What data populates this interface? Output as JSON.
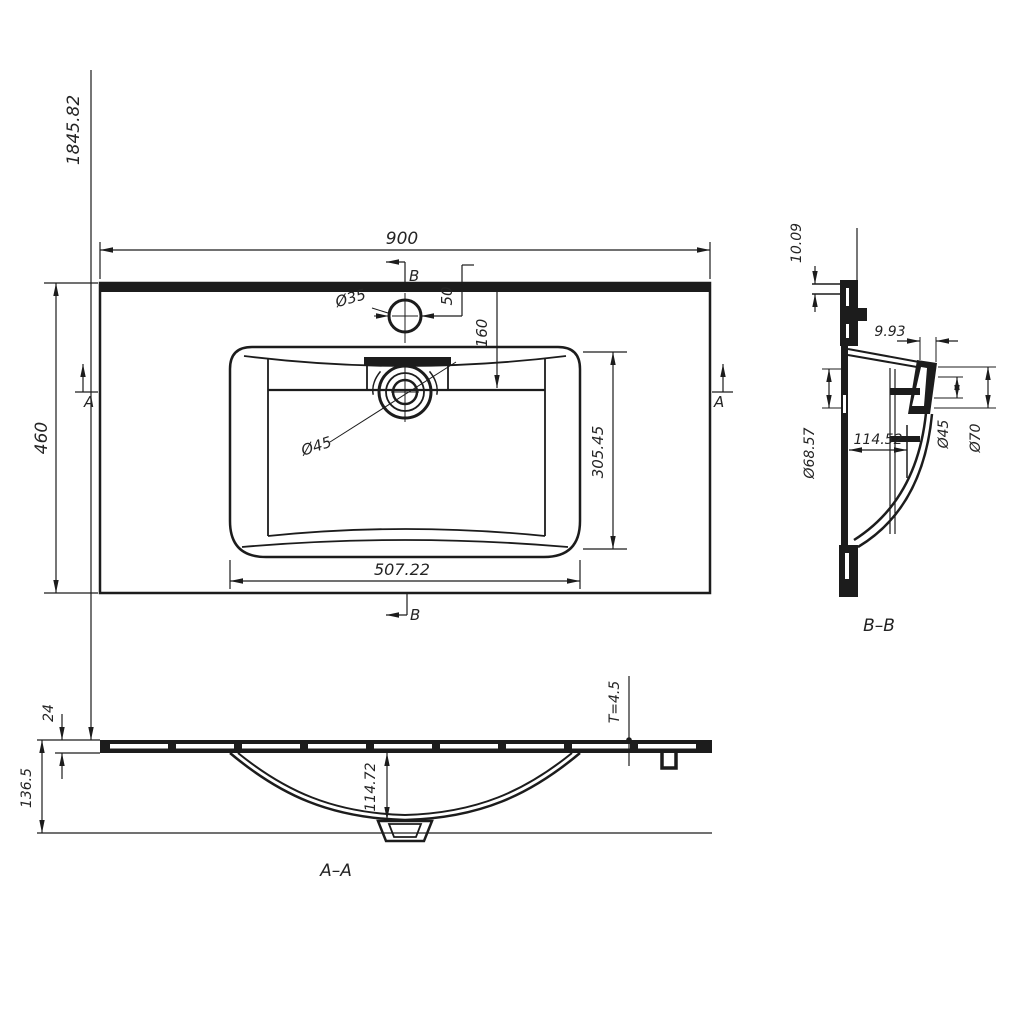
{
  "drawing": {
    "background": "#ffffff",
    "line_color": "#1c1c1c",
    "top_view": {
      "dim_width": "900",
      "dim_depth": "460",
      "dim_overall_height": "1845.82",
      "dim_faucet_hole_dia": "Ø35",
      "dim_faucet_offset": "50",
      "dim_basin_setback": "160",
      "dim_drain_dia": "Ø45",
      "dim_basin_length": "507.22",
      "dim_basin_width": "305.45",
      "cut_a": "A",
      "cut_b": "B"
    },
    "section_bb": {
      "label": "B–B",
      "dim_edge_thickness": "10.09",
      "dim_drain_neck_width": "9.93",
      "dim_recess_dia": "Ø68.57",
      "dim_depth": "114.52",
      "dim_drain_inner_dia": "Ø45",
      "dim_drain_outer_dia": "Ø70"
    },
    "section_aa": {
      "label": "A–A",
      "dim_edge_height": "24",
      "dim_total_height": "136.5",
      "dim_bowl_depth": "114.72",
      "dim_material_thickness": "T=4.5"
    }
  }
}
